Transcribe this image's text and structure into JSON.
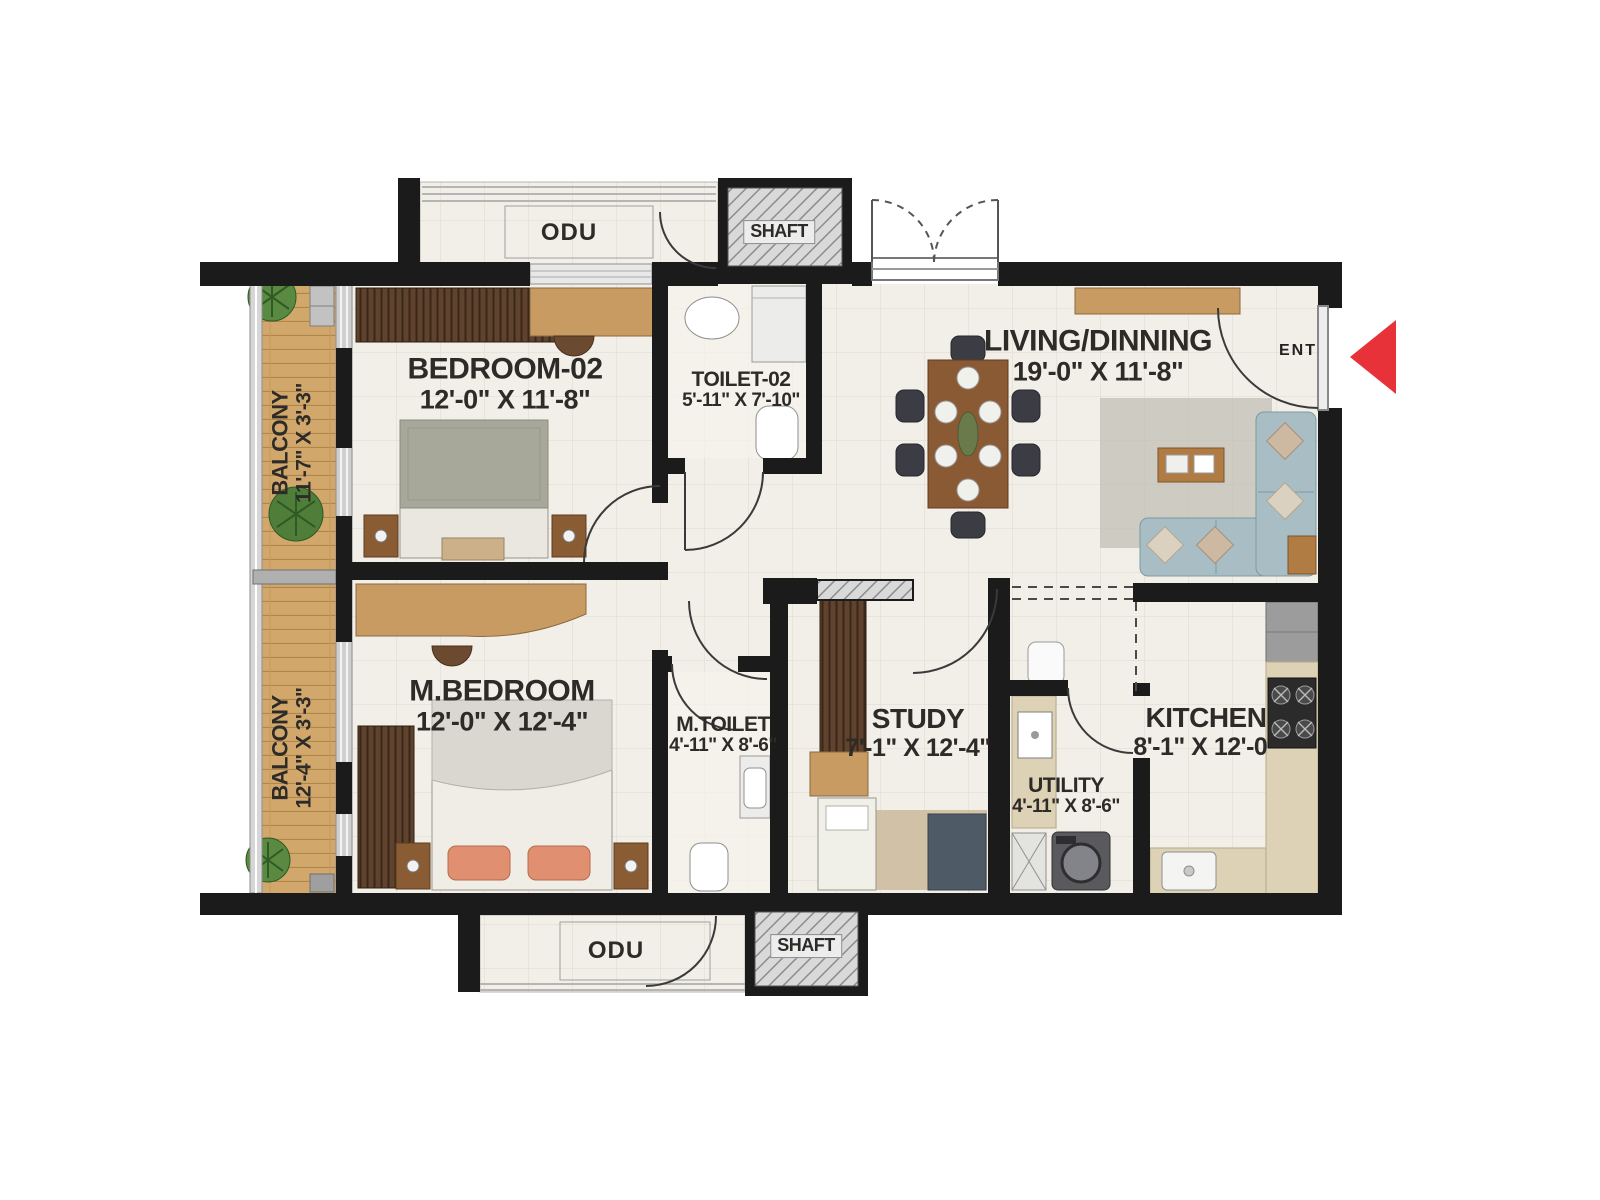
{
  "rooms": {
    "bedroom02": {
      "name": "BEDROOM-02",
      "dims": "12'-0\" X 11'-8\""
    },
    "toilet02": {
      "name": "TOILET-02",
      "dims": "5'-11\" X 7'-10\""
    },
    "living": {
      "name": "LIVING/DINNING",
      "dims": "19'-0\" X 11'-8\""
    },
    "mbedroom": {
      "name": "M.BEDROOM",
      "dims": "12'-0\" X 12'-4\""
    },
    "mtoilet": {
      "name": "M.TOILET",
      "dims": "4'-11\" X 8'-6\""
    },
    "study": {
      "name": "STUDY",
      "dims": "7'-1\" X 12'-4\""
    },
    "utility": {
      "name": "UTILITY",
      "dims": "4'-11\" X 8'-6\""
    },
    "kitchen": {
      "name": "KITCHEN",
      "dims": "8'-1\" X 12'-0\""
    },
    "balcony1": {
      "name": "BALCONY",
      "dims": "11'-7\" X 3'-3\""
    },
    "balcony2": {
      "name": "BALCONY",
      "dims": "12'-4\" X 3'-3\""
    }
  },
  "service": {
    "odu_top": "ODU",
    "shaft_top": "SHAFT",
    "odu_bottom": "ODU",
    "shaft_bottom": "SHAFT"
  },
  "entrance": {
    "label": "ENT"
  },
  "colors": {
    "wall": "#1b1b1b",
    "floor": "#f2efe8",
    "balcony_wood": "#d2a76c",
    "accent_red": "#e63238"
  }
}
